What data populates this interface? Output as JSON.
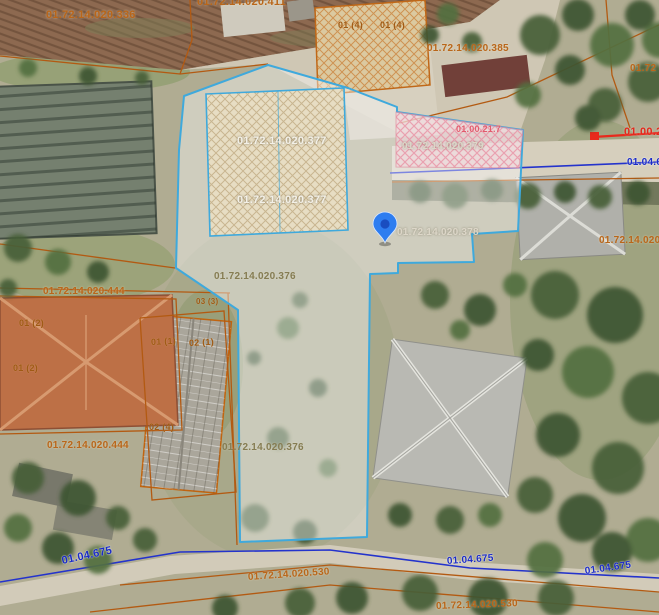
{
  "map": {
    "view": "cadastral-aerial-view",
    "colors": {
      "parcel_line_orange": "#b35a12",
      "selected_parcel_outline": "#3fa9dc",
      "selected_parcel_fill": "rgba(250,250,252,0.42)",
      "road_axis_blue": "#2433cc",
      "route_line_red": "#e8291c",
      "marker_blue": "#2e7df0",
      "hatch_pink": "#e98fa2",
      "hatch_beige": "#b49a6e",
      "hatch_orange": "#c87428"
    },
    "marker": {
      "icon": "location-pin",
      "color": "#2e7df0"
    },
    "labels": [
      {
        "text": "01.72.14.020.336",
        "x": 46,
        "y": 10,
        "cls": "orange",
        "size": 11,
        "rot": 0,
        "kind": "parcel-label"
      },
      {
        "text": "01.72.14.020.411",
        "x": 197,
        "y": -3,
        "cls": "orange",
        "size": 11,
        "rot": 0,
        "kind": "parcel-label"
      },
      {
        "text": "01 (4)",
        "x": 338,
        "y": 21,
        "cls": "darkorange",
        "size": 9,
        "rot": 0,
        "kind": "building-label"
      },
      {
        "text": "01 (4)",
        "x": 380,
        "y": 21,
        "cls": "darkorange",
        "size": 9,
        "rot": 0,
        "kind": "building-label"
      },
      {
        "text": "01.72.14.020.385",
        "x": 427,
        "y": 44,
        "cls": "orange",
        "size": 10,
        "rot": 0,
        "kind": "parcel-label"
      },
      {
        "text": "01.72",
        "x": 630,
        "y": 64,
        "cls": "orange",
        "size": 10,
        "rot": 0,
        "kind": "parcel-label"
      },
      {
        "text": "01.00.21.7",
        "x": 456,
        "y": 125,
        "cls": "pink",
        "size": 9,
        "rot": 0,
        "kind": "route-point-label"
      },
      {
        "text": "01.00.2",
        "x": 624,
        "y": 127,
        "cls": "red",
        "size": 11,
        "rot": 0,
        "kind": "route-point-label"
      },
      {
        "text": "01.72.14.020.379",
        "x": 402,
        "y": 142,
        "cls": "whitegray",
        "size": 10,
        "rot": 0,
        "kind": "parcel-label"
      },
      {
        "text": "01.04.6",
        "x": 627,
        "y": 158,
        "cls": "blue",
        "size": 10,
        "rot": 0,
        "kind": "road-label"
      },
      {
        "text": "01.72.14.020.377",
        "x": 237,
        "y": 136,
        "cls": "white",
        "size": 11,
        "rot": 0,
        "kind": "parcel-label"
      },
      {
        "text": "01.72.14.020.377",
        "x": 237,
        "y": 195,
        "cls": "white",
        "size": 11,
        "rot": 0,
        "kind": "parcel-label"
      },
      {
        "text": "01.72.14.020.378",
        "x": 397,
        "y": 228,
        "cls": "whitegray",
        "size": 10,
        "rot": 0,
        "kind": "parcel-label"
      },
      {
        "text": "01.72.14.020",
        "x": 599,
        "y": 236,
        "cls": "orange",
        "size": 10,
        "rot": 0,
        "kind": "parcel-label"
      },
      {
        "text": "01.72.14.020.376",
        "x": 214,
        "y": 272,
        "cls": "olive",
        "size": 10,
        "rot": 0,
        "kind": "parcel-label"
      },
      {
        "text": "03 (3)",
        "x": 196,
        "y": 298,
        "cls": "darkorange",
        "size": 8,
        "rot": 0,
        "kind": "building-label"
      },
      {
        "text": "01.72.14.020.444",
        "x": 43,
        "y": 287,
        "cls": "orange",
        "size": 10,
        "rot": 0,
        "kind": "parcel-label"
      },
      {
        "text": "01 (2)",
        "x": 19,
        "y": 319,
        "cls": "darkorange",
        "size": 9,
        "rot": 0,
        "kind": "building-label"
      },
      {
        "text": "01 (2)",
        "x": 13,
        "y": 364,
        "cls": "darkorange",
        "size": 9,
        "rot": 0,
        "kind": "building-label"
      },
      {
        "text": "01 (1)",
        "x": 151,
        "y": 338,
        "cls": "darkorange",
        "size": 9,
        "rot": -3,
        "kind": "building-label"
      },
      {
        "text": "02 (1)",
        "x": 189,
        "y": 339,
        "cls": "darkorange",
        "size": 9,
        "rot": -3,
        "kind": "building-label"
      },
      {
        "text": "02 (4)",
        "x": 149,
        "y": 423,
        "cls": "darkorange",
        "size": 9,
        "rot": 0,
        "kind": "building-label"
      },
      {
        "text": "01.72.14.020.444",
        "x": 47,
        "y": 441,
        "cls": "orange",
        "size": 10,
        "rot": 0,
        "kind": "parcel-label"
      },
      {
        "text": "01.72.14.020.376",
        "x": 222,
        "y": 443,
        "cls": "olive",
        "size": 10,
        "rot": 0,
        "kind": "parcel-label"
      },
      {
        "text": "01.04.675",
        "x": 62,
        "y": 556,
        "cls": "blue",
        "size": 11,
        "rot": -12,
        "kind": "road-label"
      },
      {
        "text": "01.72.14.020.530",
        "x": 248,
        "y": 573,
        "cls": "orange",
        "size": 10,
        "rot": -4,
        "kind": "parcel-label"
      },
      {
        "text": "01.04.675",
        "x": 447,
        "y": 557,
        "cls": "blue",
        "size": 10,
        "rot": -4,
        "kind": "road-label"
      },
      {
        "text": "01.04.675",
        "x": 585,
        "y": 567,
        "cls": "blue",
        "size": 10,
        "rot": -8,
        "kind": "road-label"
      },
      {
        "text": "01.72.14.020.530",
        "x": 436,
        "y": 602,
        "cls": "orange",
        "size": 10,
        "rot": -2,
        "kind": "parcel-label"
      }
    ]
  }
}
